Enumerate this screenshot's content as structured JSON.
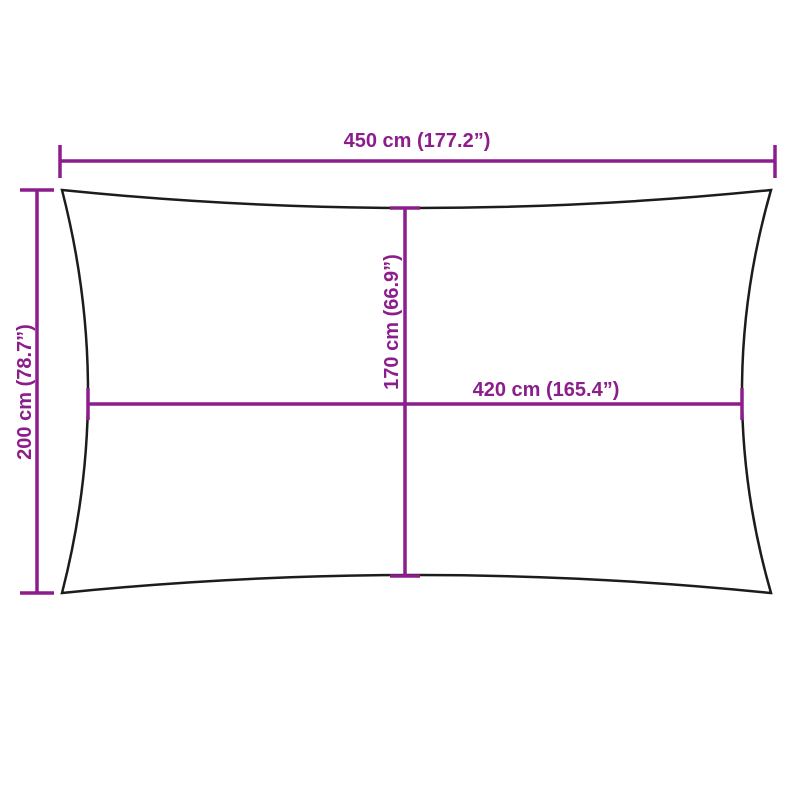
{
  "diagram": {
    "kind": "product-dimension-drawing",
    "subject": "rectangular shade sail with concave edges",
    "colors": {
      "dimension": "#8C1D8C",
      "outline": "#1C1C1C",
      "background": "#FFFFFF"
    },
    "measurements": {
      "overall_width": "450 cm (177.2”)",
      "overall_height": "200 cm (78.7”)",
      "inner_height": "170 cm (66.9”)",
      "inner_width": "420 cm (165.4”)"
    }
  }
}
